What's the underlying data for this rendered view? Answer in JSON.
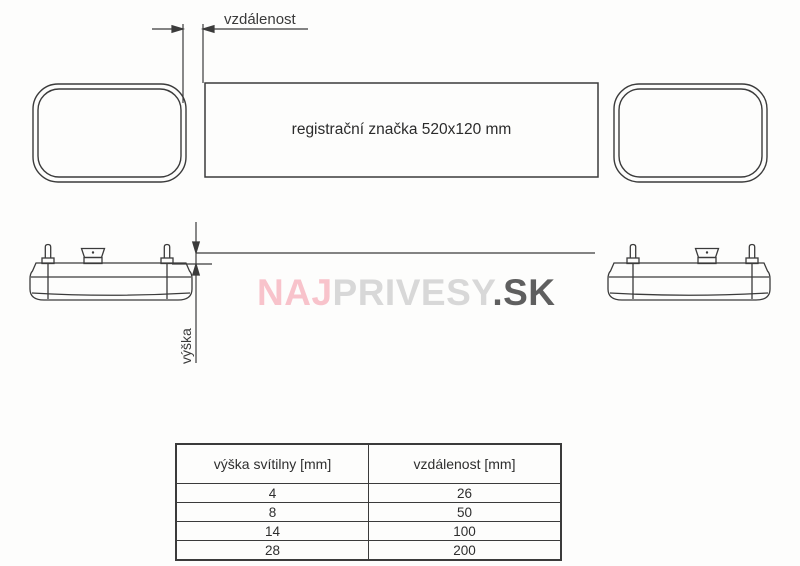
{
  "page": {
    "background": "#fdfdfc",
    "line_color": "#3b3b3b"
  },
  "top_view": {
    "distance_dimension_label": "vzdálenost",
    "plate_label": "registrační značka 520x120 mm"
  },
  "side_view": {
    "height_dimension_label": "výška"
  },
  "watermark": {
    "part_naj": "NAJ",
    "part_privesy": "PRIVESY",
    "part_sk": ".SK",
    "color_naj": "#f8c3cb",
    "color_privesy": "#d8d8d8",
    "color_sk": "#5f5f5f"
  },
  "table": {
    "headers": [
      "výška svítilny [mm]",
      "vzdálenost [mm]"
    ],
    "rows": [
      [
        "4",
        "26"
      ],
      [
        "8",
        "50"
      ],
      [
        "14",
        "100"
      ],
      [
        "28",
        "200"
      ]
    ]
  }
}
